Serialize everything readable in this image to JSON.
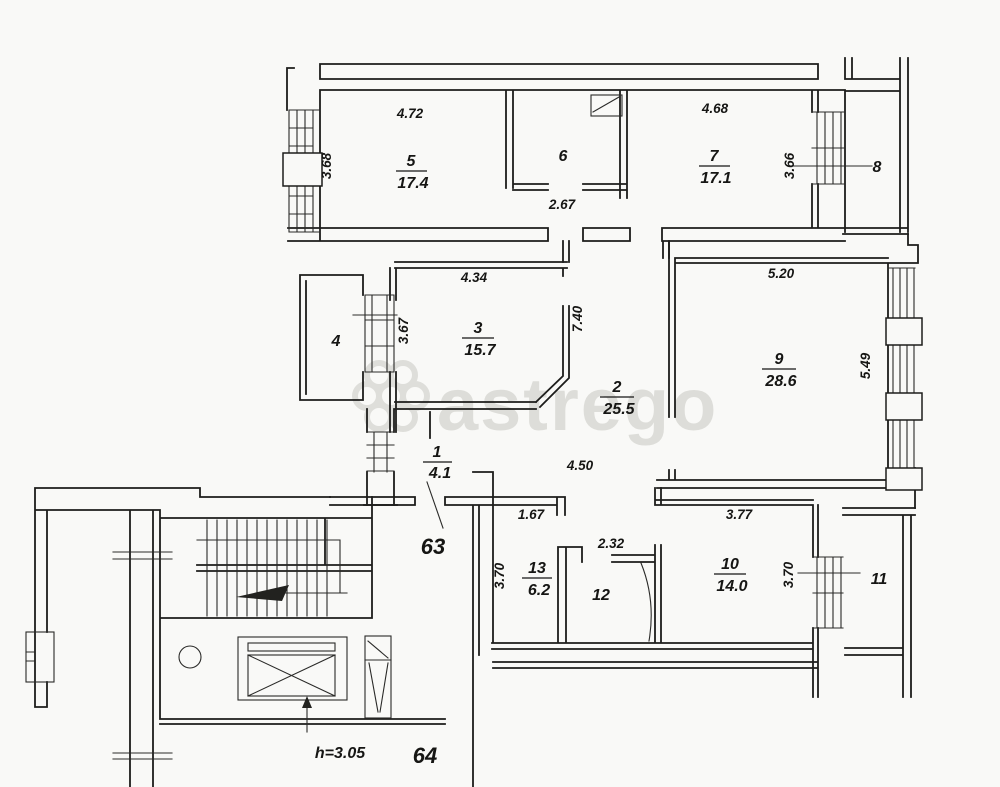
{
  "watermark": {
    "text": "astrego"
  },
  "units": {
    "apartment_left": "63",
    "apartment_bottom": "64",
    "elevator_height": "h=3.05"
  },
  "rooms": [
    {
      "number": "1",
      "area": "4.1"
    },
    {
      "number": "2",
      "area": "25.5"
    },
    {
      "number": "3",
      "area": "15.7"
    },
    {
      "number": "4"
    },
    {
      "number": "5",
      "area": "17.4"
    },
    {
      "number": "6"
    },
    {
      "number": "7",
      "area": "17.1"
    },
    {
      "number": "8"
    },
    {
      "number": "9",
      "area": "28.6"
    },
    {
      "number": "10",
      "area": "14.0"
    },
    {
      "number": "11"
    },
    {
      "number": "12"
    },
    {
      "number": "13",
      "area": "6.2"
    }
  ],
  "dimensions": {
    "room5_width": "4.72",
    "room5_depth": "3.68",
    "room6_width": "2.67",
    "room7_width": "4.68",
    "room7_depth": "3.66",
    "room3_width": "4.34",
    "room3_depth": "3.67",
    "hall_depth": "7.40",
    "room9_width": "5.20",
    "room9_depth": "5.49",
    "hall_width": "4.50",
    "wall_offset": "1.67",
    "room12_width": "2.32",
    "room13_depth": "3.70",
    "room10_width": "3.77",
    "room10_depth": "3.70"
  },
  "colors": {
    "paper": "#f9f9f7",
    "ink": "#1d1d1b",
    "watermark": "#d9d9d4"
  }
}
